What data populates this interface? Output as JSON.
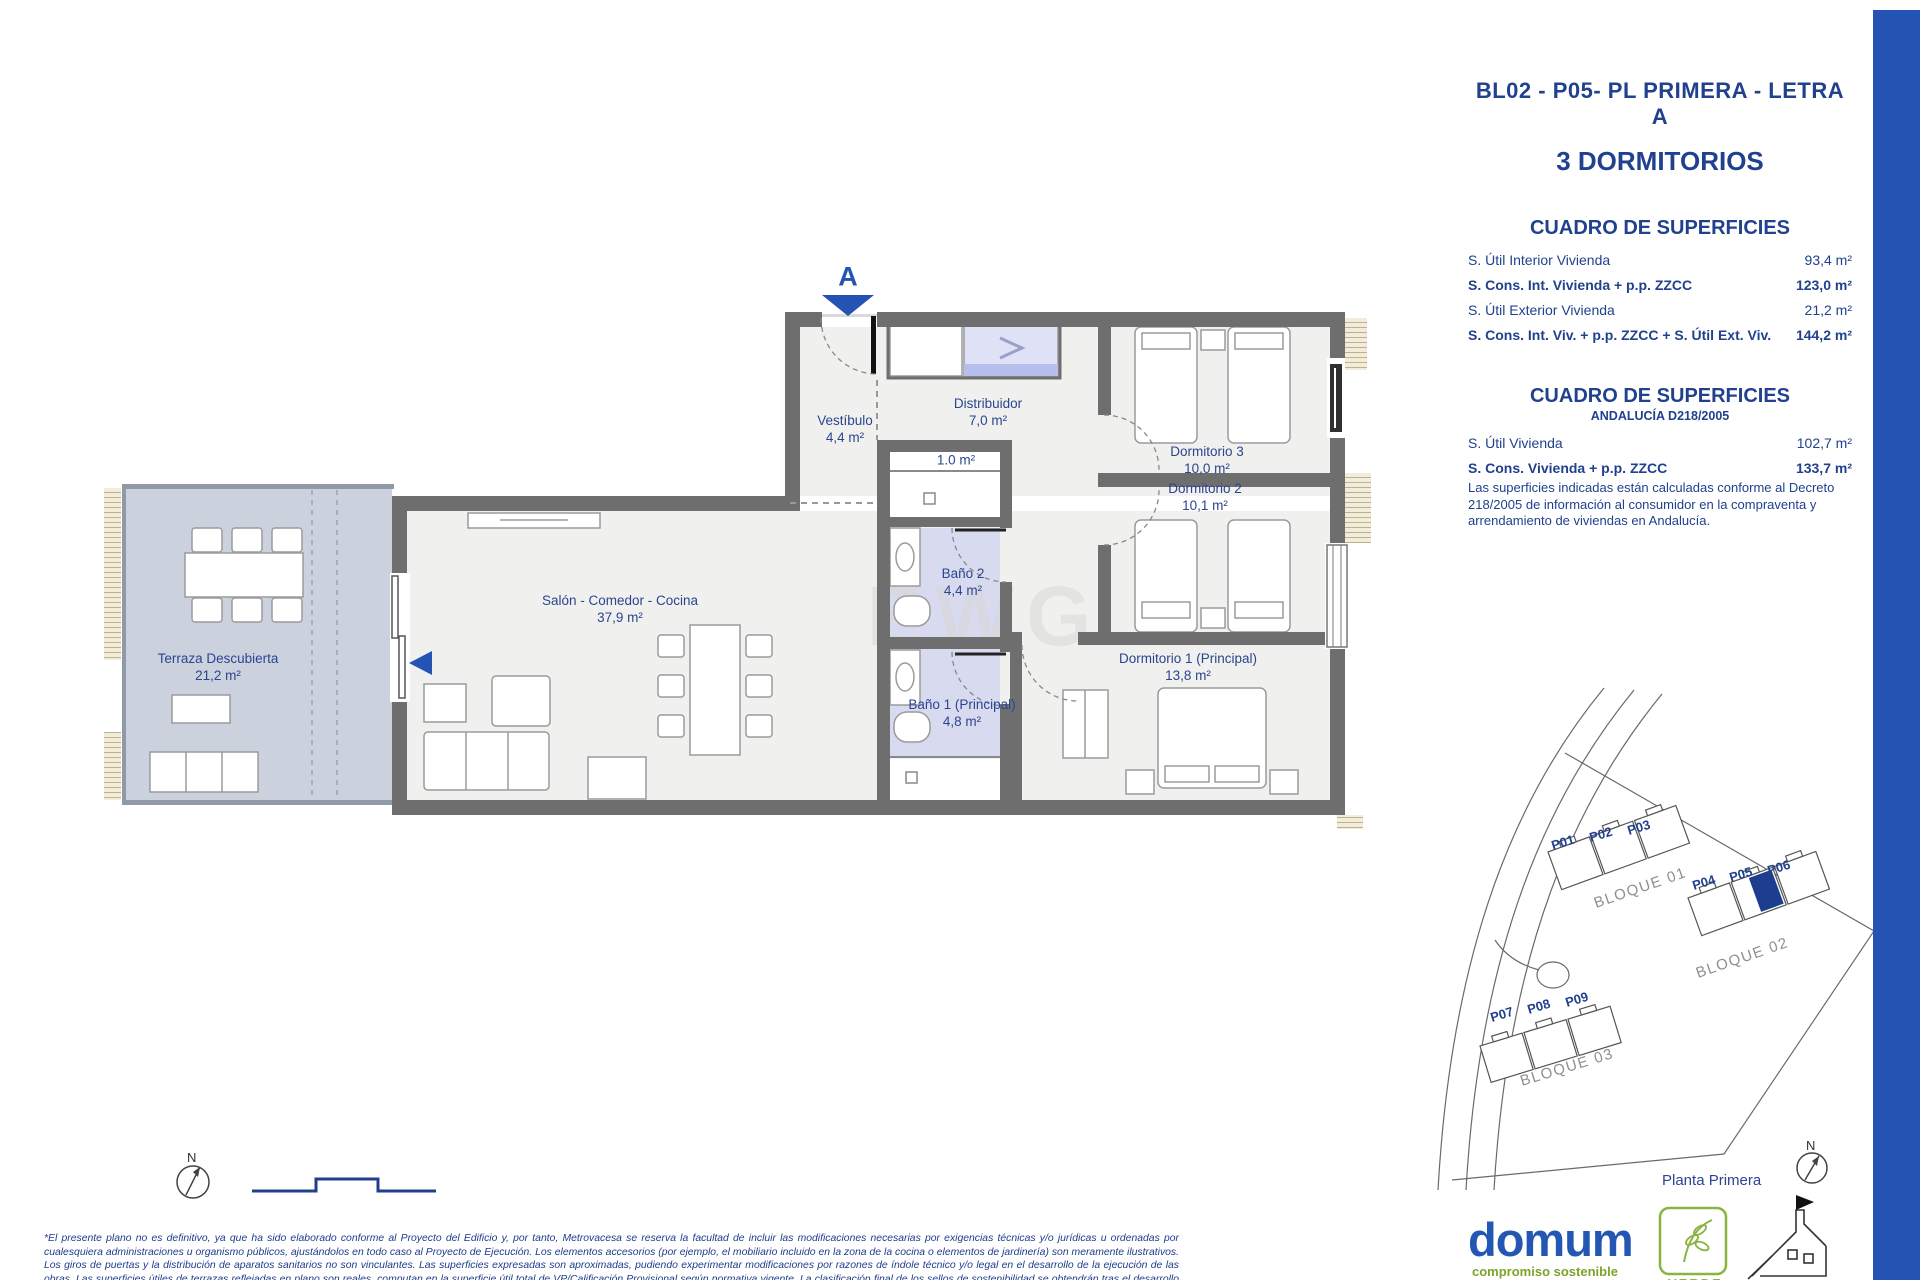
{
  "header": {
    "plan_code": "BL02 - P05- PL PRIMERA - LETRA A",
    "dwelling_type": "3 DORMITORIOS"
  },
  "surfaces_table_1": {
    "title": "CUADRO DE SUPERFICIES",
    "rows": [
      {
        "label": "S. Útil Interior Vivienda",
        "value": "93,4 m²"
      },
      {
        "label": "S. Cons. Int. Vivienda + p.p. ZZCC",
        "value": "123,0 m²"
      },
      {
        "label": "S. Útil Exterior Vivienda",
        "value": "21,2 m²"
      },
      {
        "label": "S. Cons. Int. Viv. + p.p. ZZCC + S. Útil Ext. Viv.",
        "value": "144,2 m²"
      }
    ]
  },
  "surfaces_table_2": {
    "title": "CUADRO DE SUPERFICIES",
    "subtitle": "ANDALUCÍA D218/2005",
    "rows": [
      {
        "label": "S. Útil Vivienda",
        "value": "102,7 m²"
      },
      {
        "label": "S. Cons. Vivienda + p.p. ZZCC",
        "value": "133,7 m²"
      }
    ],
    "note": "Las superficies indicadas están calculadas conforme al Decreto 218/2005 de información al consumidor en la compraventa y arrendamiento de viviendas en Andalucía."
  },
  "floorplan": {
    "entrance_label": "A",
    "watermark": "EWG",
    "closet_area": "1.0 m²",
    "rooms": [
      {
        "name": "Vestíbulo",
        "area": "4,4 m²"
      },
      {
        "name": "Distribuidor",
        "area": "7,0 m²"
      },
      {
        "name": "Dormitorio 3",
        "area": "10,0 m²"
      },
      {
        "name": "Dormitorio 2",
        "area": "10,1 m²"
      },
      {
        "name": "Baño 2",
        "area": "4,4 m²"
      },
      {
        "name": "Dormitorio 1 (Principal)",
        "area": "13,8 m²"
      },
      {
        "name": "Baño 1 (Principal)",
        "area": "4,8 m²"
      },
      {
        "name": "Salón - Comedor - Cocina",
        "area": "37,9 m²"
      },
      {
        "name": "Terraza Descubierta",
        "area": "21,2 m²"
      }
    ]
  },
  "site_plan": {
    "blocks": [
      "BLOQUE 01",
      "BLOQUE 02",
      "BLOQUE 03"
    ],
    "units": [
      "P01",
      "P02",
      "P03",
      "P04",
      "P05",
      "P06",
      "P07",
      "P08",
      "P09"
    ],
    "floor_label": "Planta Primera",
    "north_label": "N"
  },
  "footer": {
    "disclaimer": "*El presente plano no es definitivo, ya que ha sido elaborado conforme al Proyecto del Edificio y, por tanto, Metrovacesa se reserva la facultad de incluir las modificaciones necesarias por exigencias técnicas y/o jurídicas u ordenadas por cualesquiera administraciones u organismo públicos, ajustándolos en todo caso al Proyecto de Ejecución. Los elementos accesorios (por ejemplo, el mobiliario incluido en la zona de la cocina o elementos de jardinería) son meramente ilustrativos. Los giros de puertas y la distribución de aparatos sanitarios no son vinculantes. Las superficies expresadas son aproximadas, pudiendo experimentar modificaciones por razones de índole técnico y/o legal en el desarrollo de la ejecución de las obras. Las superficies útiles de terrazas reflejadas en plano son reales, computan en la superficie útil total de VP/Calificación Provisional según normativa vigente. La clasificación final de los sellos de sostenibilidad se obtendrán tras el desarrollo del Proyecto de Ejecución.",
    "brand": "domum",
    "brand_tagline": "compromiso sostenible",
    "cert_label": "VERDE"
  },
  "colors": {
    "accent_blue": "#2553b4",
    "navy_text": "#21418e",
    "highlight_unit": "#1d3e8f",
    "bath_fill": "#d8daf0",
    "terrace_fill": "#cbd1dd",
    "wall_gray": "#6e6e6e"
  }
}
